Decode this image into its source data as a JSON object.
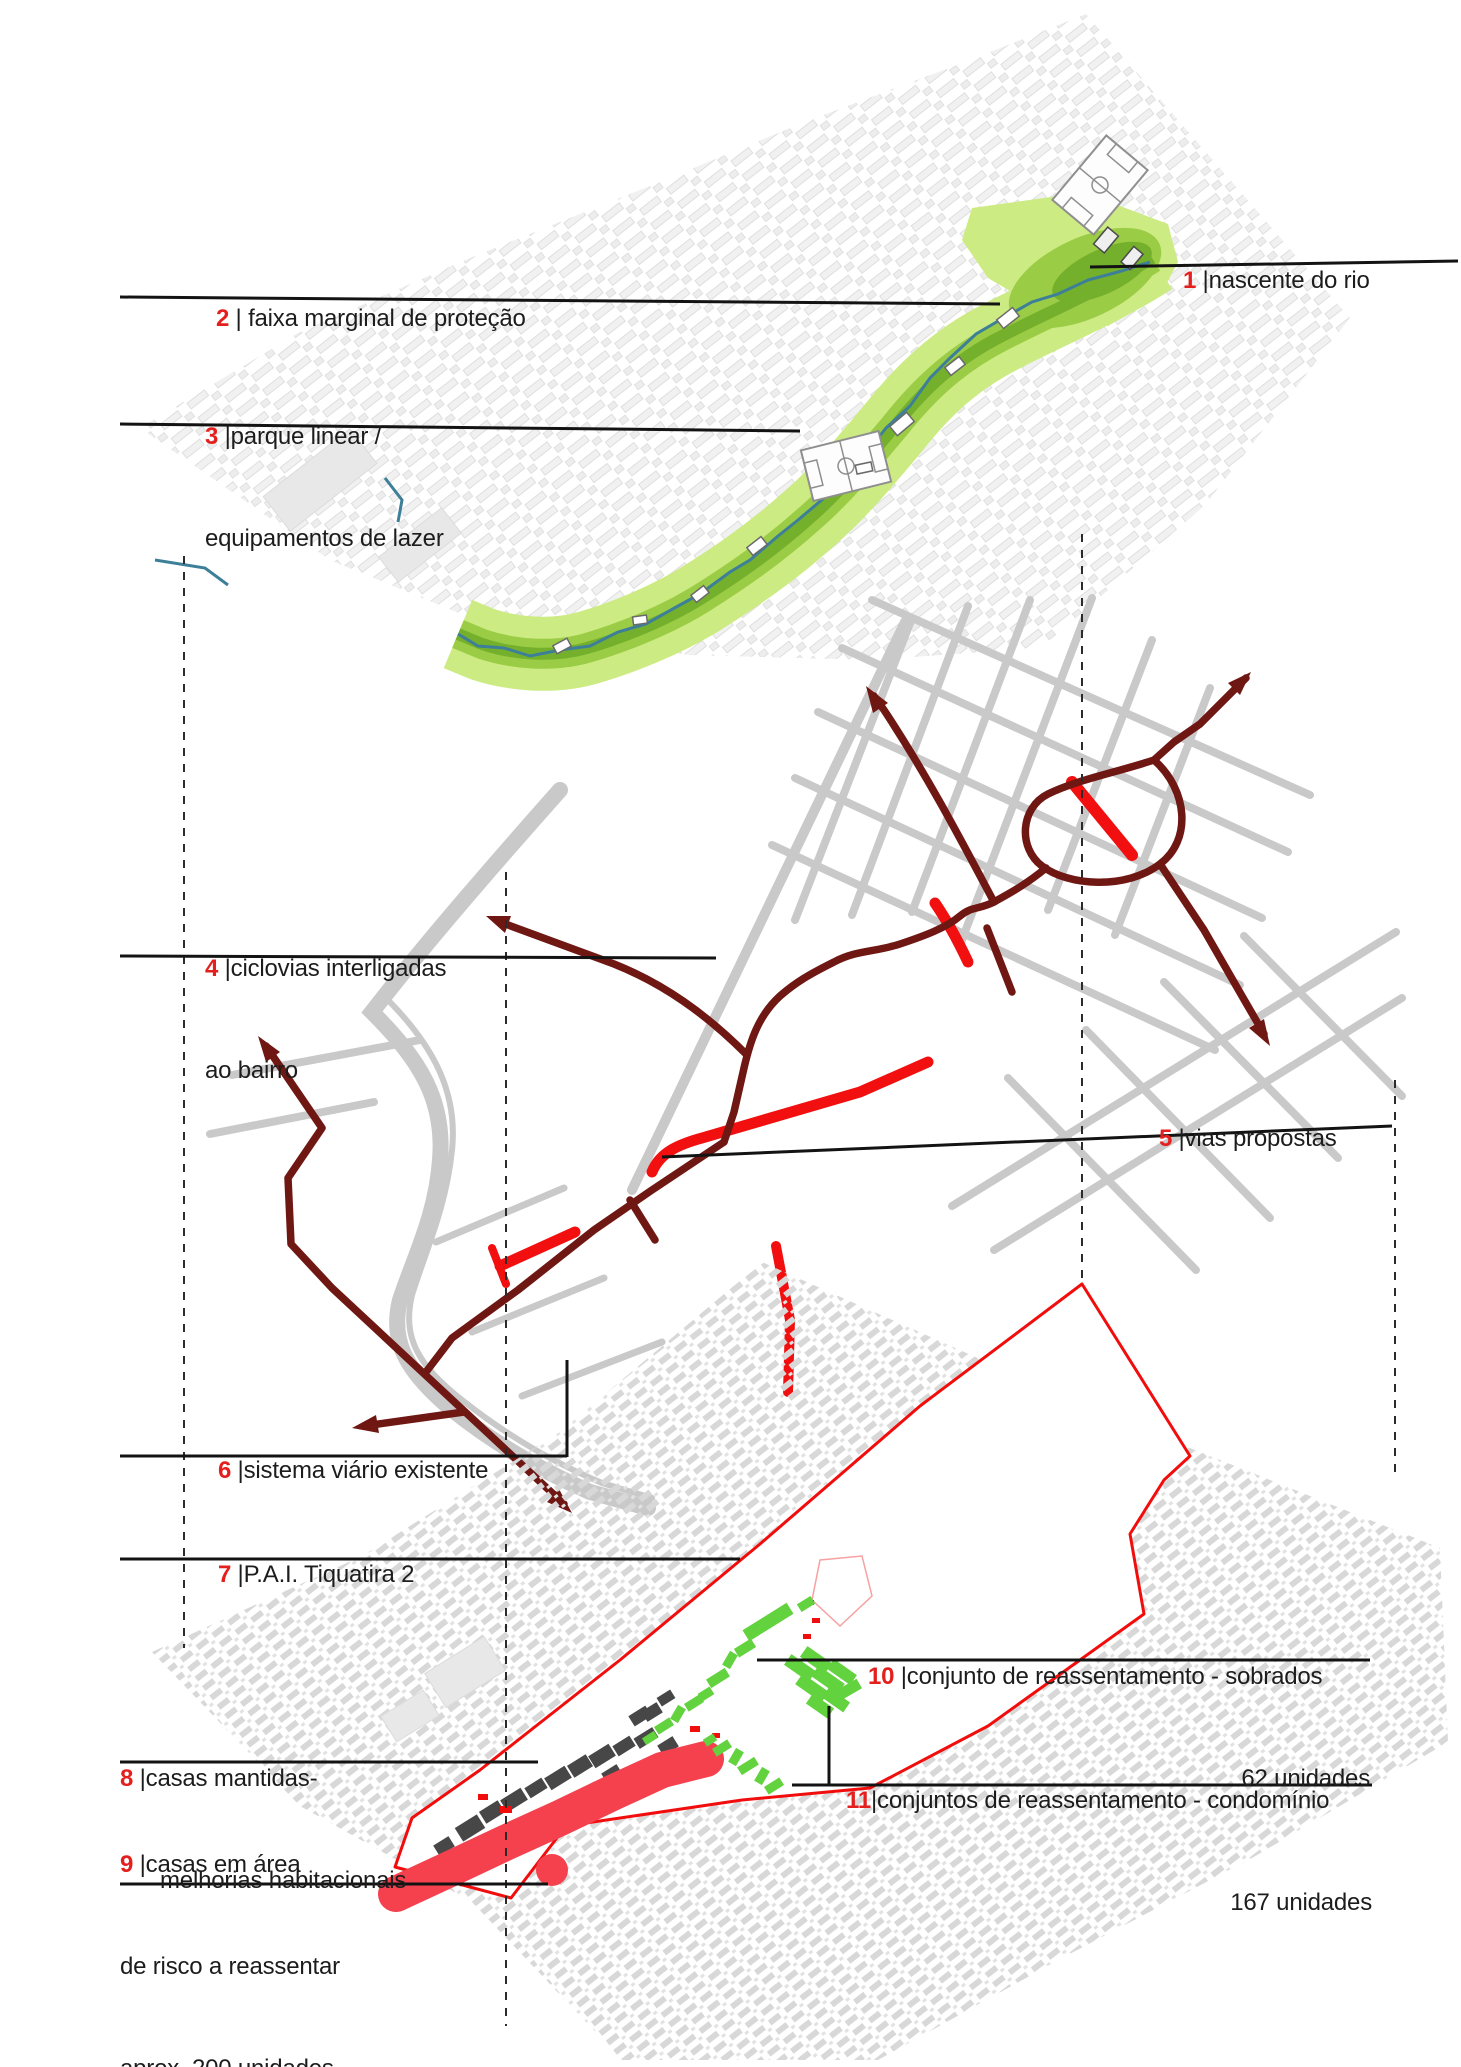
{
  "labels": {
    "l1": {
      "num": "1",
      "line1": " |nascente do rio"
    },
    "l2": {
      "num": "2",
      "line1": " | faixa marginal de proteção"
    },
    "l3": {
      "num": "3",
      "line1": " |parque linear /",
      "line2": "equipamentos de lazer"
    },
    "l4": {
      "num": "4",
      "line1": " |ciclovias interligadas",
      "line2": "ao bairro"
    },
    "l5": {
      "num": "5",
      "line1": " |vias propostas"
    },
    "l6": {
      "num": "6",
      "line1": " |sistema viário existente"
    },
    "l7": {
      "num": "7",
      "line1": " |P.A.I. Tiquatira 2"
    },
    "l8": {
      "num": "8",
      "line1": " |casas mantidas-",
      "line2": "melhorias habitacionais"
    },
    "l9": {
      "num": "9",
      "line1": " |casas em área",
      "line2": "de risco a reassentar",
      "line3": "aprox. 200 unidades"
    },
    "l10": {
      "num": "10",
      "line1": " |conjunto de reassentamento - sobrados",
      "line2": "62 unidades"
    },
    "l11": {
      "num": "11",
      "line1": "|conjuntos de reassentamento - condomínio",
      "line2": "167 unidades"
    }
  },
  "colors": {
    "accent_red": "#e4201e",
    "cycleway_maroon": "#6f1713",
    "proposed_road_red": "#f20f0f",
    "boundary_red": "#f20d0d",
    "risk_area_red": "#f4414d",
    "resettlement_green": "#62d23e",
    "park_green_light": "#cdeb83",
    "park_green_mid": "#9bcc45",
    "park_green_dark": "#74b02c",
    "river_teal": "#3d7f99",
    "existing_road_gray": "#c9c9c9"
  }
}
